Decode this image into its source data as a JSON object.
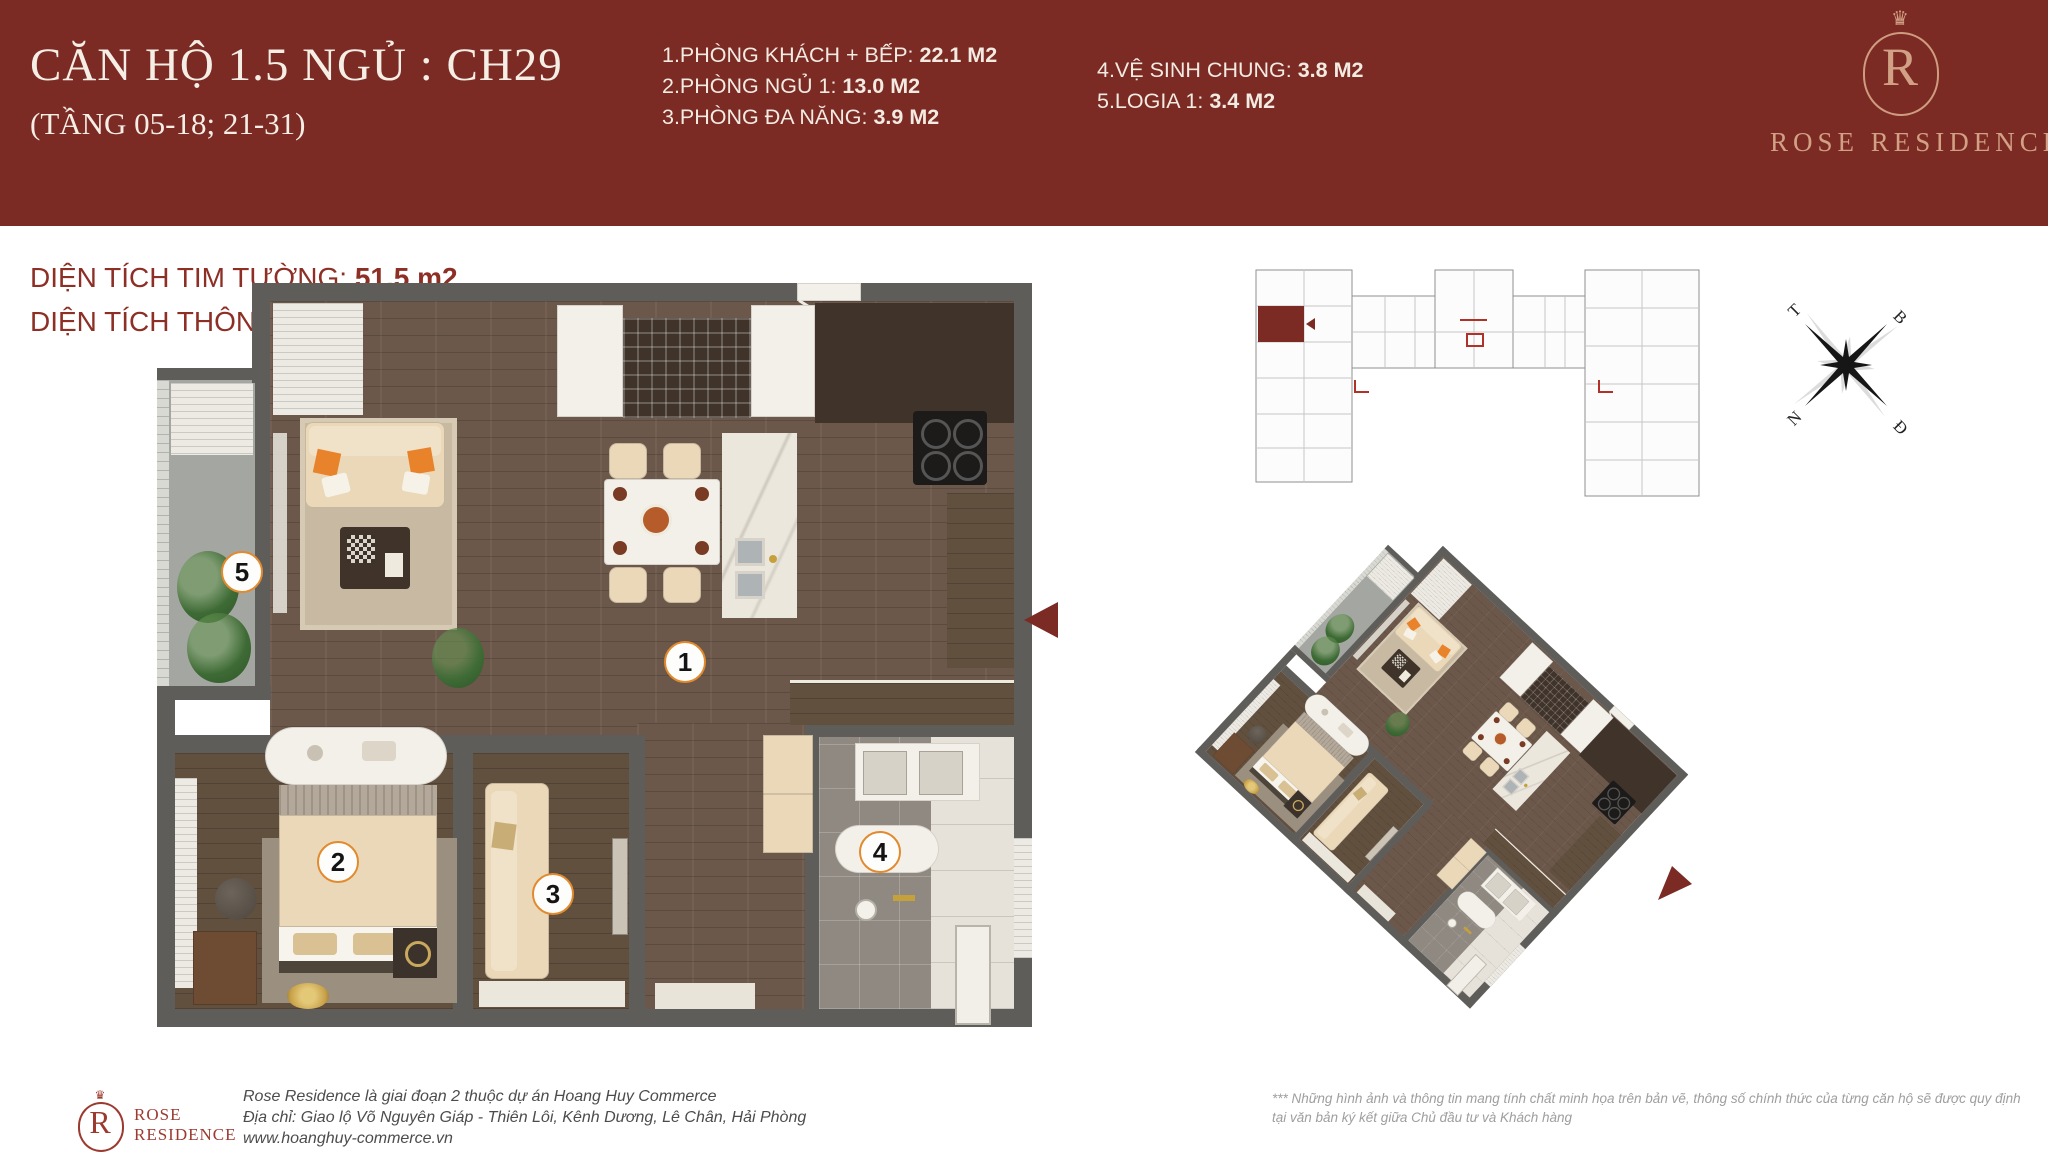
{
  "header": {
    "title": "CĂN HỘ 1.5 NGỦ : CH29",
    "subtitle": "(TẦNG 05-18; 21-31)",
    "rooms_col1": [
      {
        "label": "1.PHÒNG KHÁCH + BẾP: ",
        "value": "22.1 M2"
      },
      {
        "label": "2.PHÒNG NGỦ 1: ",
        "value": "13.0 M2"
      },
      {
        "label": "3.PHÒNG ĐA NĂNG: ",
        "value": "3.9 M2"
      }
    ],
    "rooms_col2": [
      {
        "label": "4.VỆ SINH CHUNG: ",
        "value": "3.8 M2"
      },
      {
        "label": "5.LOGIA 1: ",
        "value": "3.4 M2"
      }
    ],
    "brand": {
      "monogram": "R",
      "name": "ROSE RESIDENCE"
    }
  },
  "areas": {
    "line1_label": "DIỆN TÍCH TIM TƯỜNG: ",
    "line1_value": "51.5 m2",
    "line2_label": "DIỆN TÍCH THÔNG THỦY: ",
    "line2_value": "46.2 m2"
  },
  "floorplan": {
    "numbers": [
      "1",
      "2",
      "3",
      "4",
      "5"
    ]
  },
  "compass": {
    "t": "T",
    "b": "B",
    "n": "N",
    "d": "Đ"
  },
  "footer": {
    "brand_line1": "ROSE",
    "brand_line2": "RESIDENCE",
    "brand_monogram": "R",
    "address_lines": [
      "Rose Residence là giai đoạn 2 thuộc dự án Hoang Huy Commerce",
      "Địa chỉ: Giao lộ Võ Nguyên Giáp - Thiên Lôi, Kênh Dương, Lê Chân, Hải Phòng",
      "www.hoanghuy-commerce.vn"
    ],
    "disclaimer_lines": [
      "*** Những hình ảnh và thông tin mang tính chất minh họa trên bản vẽ, thông số chính thức của từng căn hộ sẽ được quy định",
      "tại văn bản ký kết giữa Chủ đầu tư và Khách hàng"
    ]
  },
  "colors": {
    "header_red": "#7b2a24",
    "accent_gold": "#d2a084",
    "area_text_red": "#8e2f26",
    "number_ring_orange": "#e28a2e",
    "wall_gray": "#5f5d5a"
  }
}
